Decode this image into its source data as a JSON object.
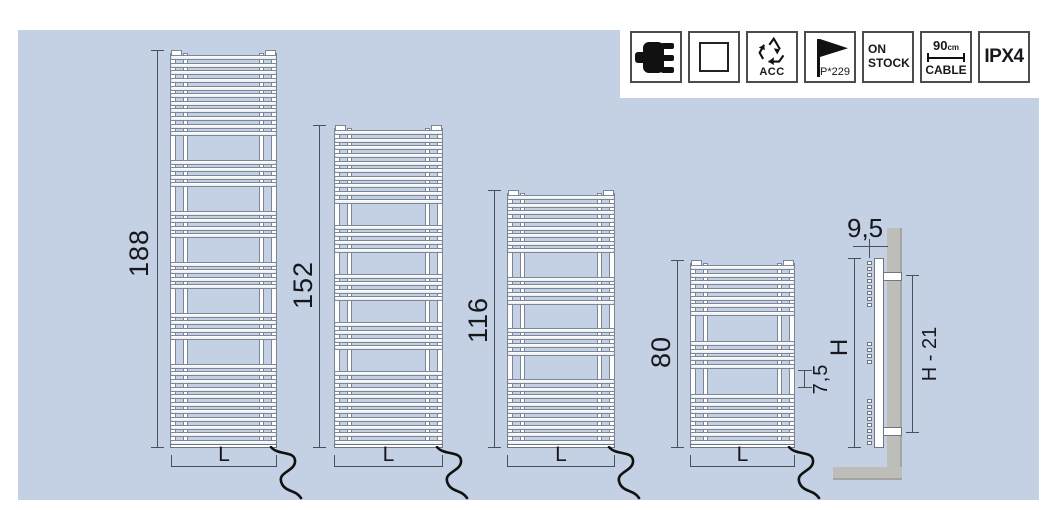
{
  "icon_bar": {
    "items": [
      {
        "name": "plug"
      },
      {
        "name": "square"
      },
      {
        "name": "recycle",
        "label": "ACC"
      },
      {
        "name": "flag",
        "label": "P*229"
      },
      {
        "name": "stock",
        "line1": "ON",
        "line2": "STOCK"
      },
      {
        "name": "cable",
        "value": "90",
        "unit": "cm",
        "label": "CABLE"
      },
      {
        "name": "rating",
        "label": "IPX4"
      }
    ]
  },
  "radiators": [
    {
      "height_label": "188",
      "width_label": "L",
      "bar_groups": [
        11,
        4,
        4,
        4,
        4,
        11
      ]
    },
    {
      "height_label": "152",
      "width_label": "L",
      "bar_groups": [
        10,
        4,
        4,
        4,
        10
      ]
    },
    {
      "height_label": "116",
      "width_label": "L",
      "bar_groups": [
        8,
        4,
        4,
        9
      ]
    },
    {
      "height_label": "80",
      "width_label": "L",
      "bar_groups": [
        7,
        4,
        7
      ]
    }
  ],
  "side_view": {
    "depth_label": "9,5",
    "height_label": "H",
    "bracket_span_label": "H - 21",
    "tube_spacing_label": "7,5",
    "plug_groups": [
      8,
      4,
      8
    ]
  },
  "colors": {
    "panel_blue": "#c4d0e3",
    "wall_gray": "#bdbdb9",
    "dimension_line": "#49505c",
    "cord_black": "#111111"
  }
}
